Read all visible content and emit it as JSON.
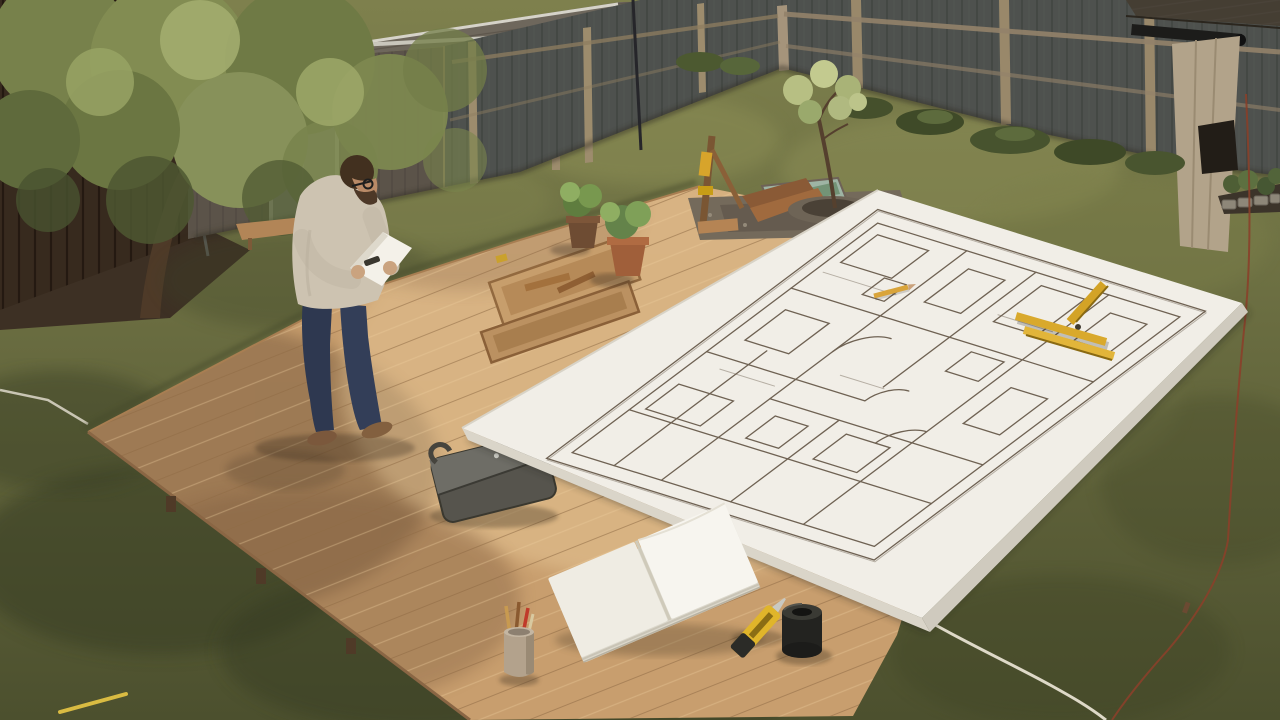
{
  "scene": {
    "type": "photographic backyard scene, high-angle view",
    "description": "A man stands on a light wooden deck in a fenced backyard, reading a sheet of paper beside a giant hand-drawn floor plan board laid over the deck and lawn, with a shed, tree, potted plants, notebook and tools around him.",
    "setting": "backyard with shed, grey fence and olive lawn",
    "time_of_day": "daytime"
  },
  "palette": {
    "grass": "#6a6c40",
    "grass_shadow": "#3e4226",
    "deck_wood": "#c89e6e",
    "deck_seam": "#8f6b45",
    "paper_white": "#f1eee7",
    "plan_ink": "#6f6253",
    "fence_grey": "#4e514e",
    "fence_trim": "#99886a",
    "shed_wall": "#5b5349",
    "shed_roof": "#6e675c",
    "shed_door": "#8f9089",
    "foliage_green": "#7d8850",
    "accent_yellow": "#d9a92c",
    "denim_blue": "#2e3850",
    "sweater_beige": "#cdc3b1",
    "skin": "#b98a67",
    "terracotta": "#a05f3a",
    "tape_black": "#232320",
    "mulch_brown": "#3d3024",
    "string_white": "#ded9c8",
    "string_red": "#8a402a"
  },
  "objects": {
    "lawn": {
      "label": "Olive-green lawn with mottled light and tree shadows"
    },
    "deck": {
      "label": "Light wooden deck platform with diagonal planks"
    },
    "man": {
      "label": "Man reading a sheet of paper",
      "sweater": "light beige sweater",
      "jeans": "dark blue jeans",
      "shoes": "brown shoes",
      "hair": "short brown hair with beard and glasses"
    },
    "paper_sheet": {
      "label": "White sheet of paper held in hands"
    },
    "blueprint": {
      "label": "Giant hand-drawn floor plan board lying across deck and grass"
    },
    "rulers": {
      "label": "Yellow folding rulers lying on the plan"
    },
    "pencil": {
      "label": "Yellow pencil on the plan"
    },
    "shed": {
      "label": "Grey garden shed with shingled roof and pale door"
    },
    "fence": {
      "label": "Dark grey backyard fence with tan posts and rails"
    },
    "wood_fence": {
      "label": "Dark brown wooden fence behind the tree"
    },
    "tree": {
      "label": "Leafy tree overhanging the top-left corner"
    },
    "sapling": {
      "label": "Young sapling planted in a gravel ring"
    },
    "mulch_bed": {
      "label": "Mulch bed with round stepping stone and boards"
    },
    "bench": {
      "label": "Small wooden bench at the shed base"
    },
    "potted_plants": {
      "label": "Two potted herbs in brown and terracotta pots"
    },
    "planter_trays": {
      "label": "Shallow wooden trays with wood offcuts"
    },
    "wood_stand": {
      "label": "Wooden stand with yellow clamps and leaning boards"
    },
    "mirror": {
      "label": "Reflective glass panel on the deck edge"
    },
    "gravel": {
      "label": "Gravel strip along the deck edge"
    },
    "notebook": {
      "label": "Open blank notebook on the deck"
    },
    "utility_knife": {
      "label": "Yellow utility knife"
    },
    "tape_roll": {
      "label": "Black roll of tape standing upright"
    },
    "pencil_cup": {
      "label": "Small cup holding pencils, one red"
    },
    "tool_case": {
      "label": "Flat grey tool case with handle"
    },
    "garden_bed": {
      "label": "Stone-edged garden bed with plants, bottom right"
    },
    "bushes": {
      "label": "Low bushes along the fence base"
    },
    "right_structure": {
      "label": "Neighbouring shed corner with dark roof and pipe"
    },
    "string_white": {
      "label": "White marking string across the lawn"
    },
    "string_red": {
      "label": "Red marking string along the right lawn"
    },
    "string_yellow": {
      "label": "Short yellow marking line, bottom left"
    }
  }
}
